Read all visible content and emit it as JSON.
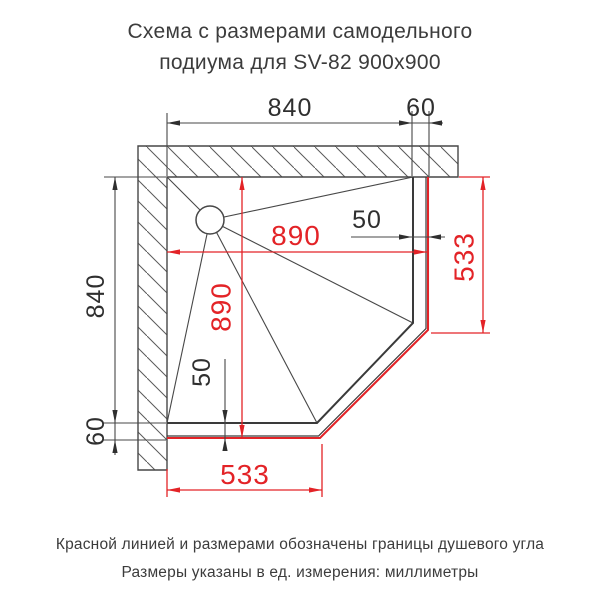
{
  "title": {
    "line1": "Схема с размерами самодельного",
    "line2": "подиума для SV-82 900x900"
  },
  "footer": {
    "line1": "Красной линией и размерами обозначены границы душевого угла",
    "line2": "Размеры указаны в ед. измерения: миллиметры"
  },
  "dims": {
    "top_width": "840",
    "top_edge": "60",
    "left_height": "840",
    "left_edge": "60",
    "shower_w": "890",
    "shower_h": "890",
    "gap_right": "50",
    "gap_bottom": "50",
    "side_right": "533",
    "side_bottom": "533"
  },
  "colors": {
    "line_gray": "#474747",
    "outline_black": "#3a3a3a",
    "shower_red": "#e32327",
    "text_dark": "#2f2f2f"
  }
}
